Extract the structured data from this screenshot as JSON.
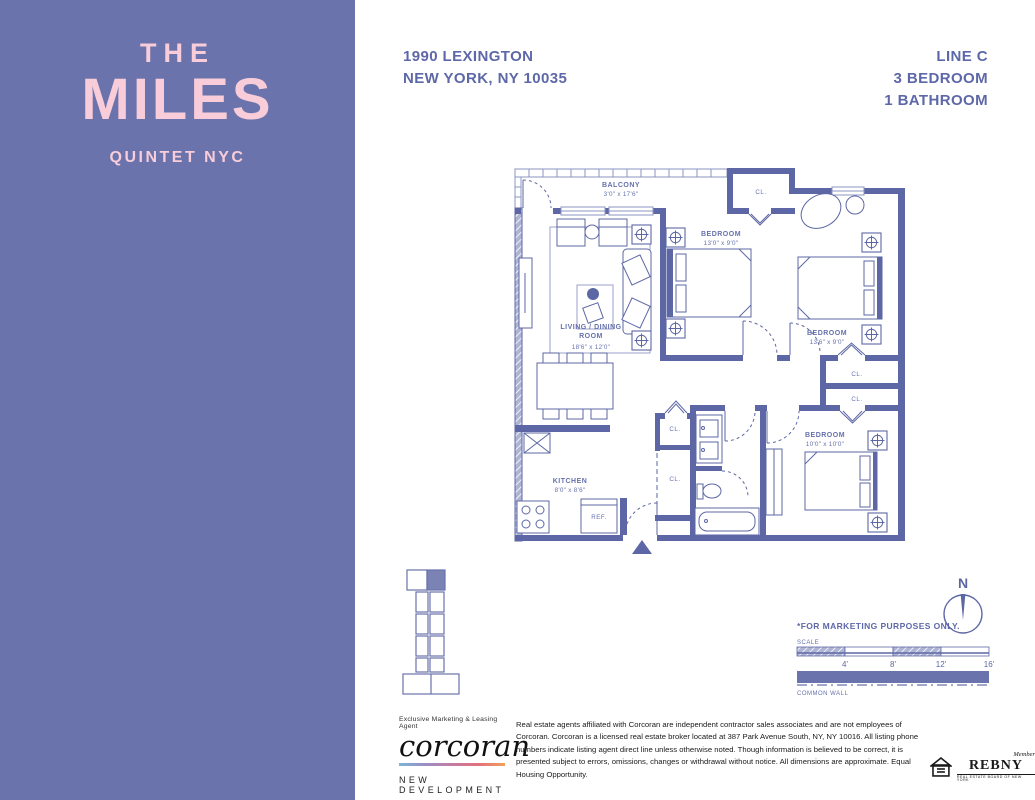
{
  "sidebar": {
    "title_line1": "THE",
    "title_line2": "MILES",
    "subtitle": "QUINTET NYC"
  },
  "header": {
    "address_line1": "1990 LEXINGTON",
    "address_line2": "NEW YORK, NY 10035",
    "line": "LINE C",
    "bedrooms": "3 BEDROOM",
    "bathrooms": "1 BATHROOM"
  },
  "floorplan": {
    "rooms": {
      "balcony": {
        "name": "BALCONY",
        "dims": "3'0\" x 17'6\""
      },
      "living": {
        "line1": "LIVING / DINING",
        "line2": "ROOM",
        "dims": "18'6\" x 12'0\""
      },
      "bedroom1": {
        "name": "BEDROOM",
        "dims": "13'0\" x 9'0\""
      },
      "bedroom2": {
        "name": "BEDROOM",
        "dims": "13'6\" x 9'0\""
      },
      "bedroom3": {
        "name": "BEDROOM",
        "dims": "10'0\" x 10'0\""
      },
      "kitchen": {
        "name": "KITCHEN",
        "dims": "8'0\" x 8'6\""
      }
    },
    "closet_label": "CL.",
    "ref_label": "REF."
  },
  "legend": {
    "marketing_note": "*FOR MARKETING PURPOSES ONLY.",
    "scale_label": "SCALE",
    "scale_ticks": [
      "4'",
      "8'",
      "12'",
      "16'"
    ],
    "common_wall_label": "COMMON WALL",
    "compass_label": "N"
  },
  "footer": {
    "agent_label": "Exclusive Marketing & Leasing Agent",
    "brand": "corcoran",
    "division": "NEW DEVELOPMENT",
    "legal": "Real estate agents affiliated with Corcoran are independent contractor sales associates and are not employees of Corcoran. Corcoran is a licensed real estate broker located at 387 Park Avenue South, NY, NY 10016. All listing phone numbers indicate listing agent direct line unless otherwise noted. Though information is believed to be correct, it is presented subject to errors, omissions, changes or withdrawal without notice. All dimensions are approximate. Equal Housing Opportunity.",
    "rebny_member": "Member",
    "rebny_name": "REBNY",
    "rebny_tagline": "REAL ESTATE BOARD OF NEW YORK"
  },
  "colors": {
    "sidebar": "#6A73AC",
    "brand_pink": "#F8CDD9",
    "plan": "#5D67A5",
    "header_text": "#5E68A8"
  }
}
